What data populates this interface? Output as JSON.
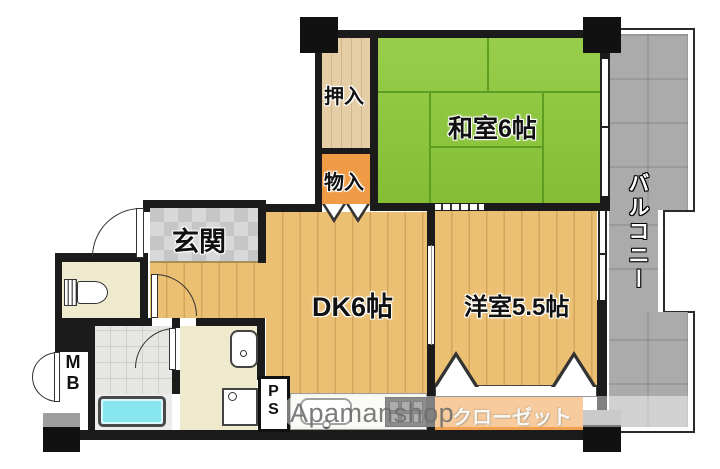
{
  "floorplan": {
    "rooms": {
      "washitsu_label": "和室6帖",
      "dk_label": "DK6帖",
      "yoshitsu_label": "洋室5.5帖",
      "genkan_label": "玄関",
      "oshiire_label": "押入",
      "monoire_label": "物入",
      "closet_label": "クローゼット",
      "balcony_label": "バルコニー",
      "mb_label": "MB",
      "ps_label": "PS"
    },
    "watermark": "Apamanshop",
    "colors": {
      "tatami_green": "#8cc837",
      "wood_floor": "#ebc073",
      "storage_orange": "#ef9a44",
      "closet_orange": "#f1a14e",
      "balcony_gray": "#ababab",
      "bathtub_cyan": "#87e6ee",
      "entry_tile_gray": "#d2d2d2",
      "wall_black": "#1b1b1b"
    }
  }
}
